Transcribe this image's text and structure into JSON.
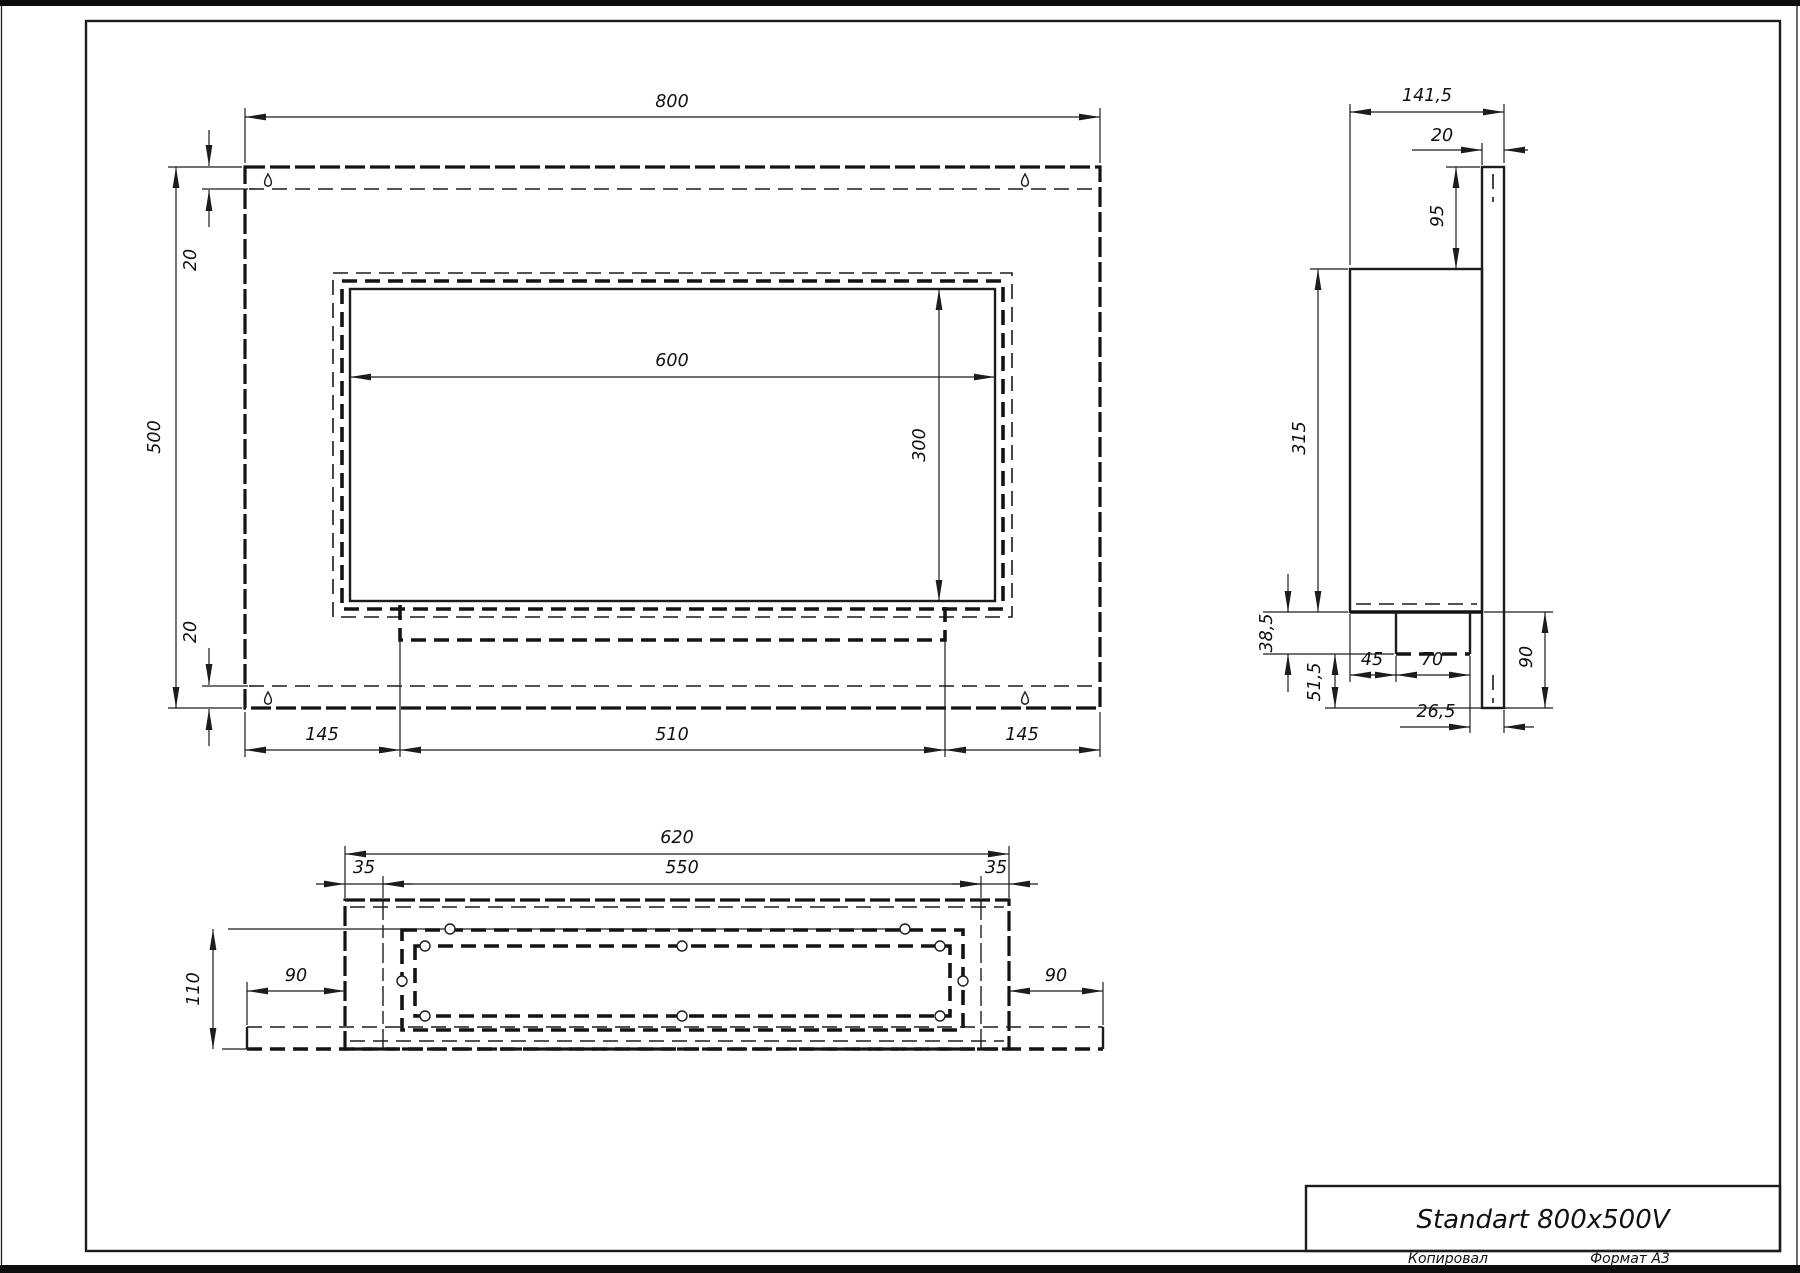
{
  "page": {
    "copied_label": "Копировал",
    "format_label": "Формат A3",
    "line_color": "#1c1c1c",
    "background": "#ffffff"
  },
  "title_block": {
    "title": "Standart 800x500V"
  },
  "front_view": {
    "dims": {
      "width": "800",
      "height": "500",
      "top_inset": "20",
      "bottom_inset": "20",
      "opening_width": "600",
      "opening_height": "300",
      "margin_left": "145",
      "tray_width": "510",
      "margin_right": "145"
    }
  },
  "side_view": {
    "dims": {
      "depth": "141,5",
      "panel_thickness": "20",
      "body_top_offset": "95",
      "body_height": "315",
      "tray_depth": "38,5",
      "tray_to_bottom": "51,5",
      "tray_setback": "45",
      "tray_width": "70",
      "panel_below_body": "90",
      "rear_offset": "26,5"
    }
  },
  "bottom_view": {
    "dims": {
      "body_width": "620",
      "side_inset_left": "35",
      "opening_width": "550",
      "side_inset_right": "35",
      "depth": "110",
      "flange_left": "90",
      "flange_right": "90"
    }
  }
}
